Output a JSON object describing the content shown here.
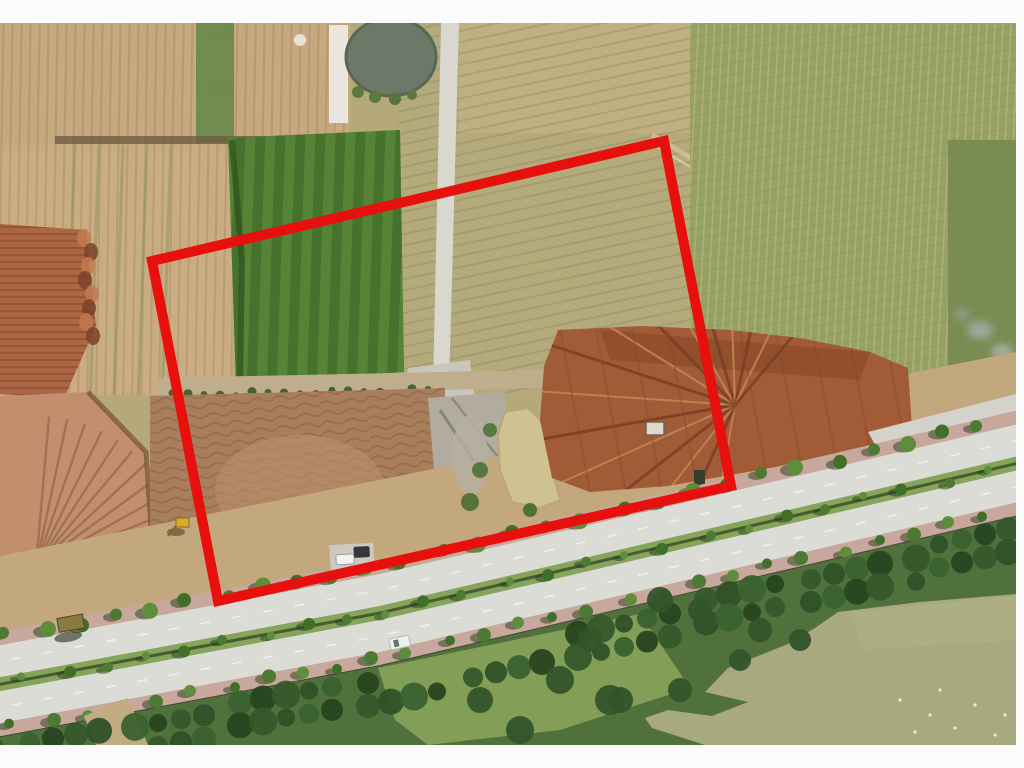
{
  "meta": {
    "type": "annotated-aerial-photograph",
    "alt": "Drone aerial view of cleared farmland and excavated earth parcels beside a tree-lined boulevard, with a red quadrilateral marking a land parcel boundary"
  },
  "frame": {
    "background": "#fbfbfb",
    "photo": {
      "x": 0,
      "y": 23,
      "width": 1016,
      "height": 722
    }
  },
  "annotation": {
    "name": "land-parcel-boundary",
    "color": "#e8100c",
    "stroke_width": 10,
    "points": "152,261 664,141 731,486 218,601"
  },
  "road": {
    "centerline": [
      [
        -20,
        692
      ],
      [
        380,
        617
      ],
      [
        1040,
        462
      ]
    ],
    "bands": [
      {
        "name": "sidewalk-north",
        "offset": -57,
        "width": 14,
        "color": "#c8a79c"
      },
      {
        "name": "carriageway-north",
        "offset": -43,
        "width": 32,
        "color": "#dbdcd5"
      },
      {
        "name": "median",
        "offset": -11,
        "width": 14,
        "color": "#86a45c"
      },
      {
        "name": "carriageway-south",
        "offset": 3,
        "width": 32,
        "color": "#dbdcd5"
      },
      {
        "name": "sidewalk-south",
        "offset": 35,
        "width": 13,
        "color": "#c8a79c"
      },
      {
        "name": "boundary-wall",
        "offset": 48,
        "width": 5,
        "color": "#41463a"
      }
    ],
    "lane_marks": {
      "color": "#f2f2ee",
      "offsets": [
        -27,
        19
      ],
      "dash": "10 22"
    },
    "median_line": {
      "color": "#3e5429",
      "offset": -4,
      "width": 3
    },
    "tree_rows": [
      {
        "offset": -51,
        "start": 8,
        "spacing": 36,
        "rmin": 6,
        "rmax": 8
      },
      {
        "offset": -4,
        "start": 26,
        "spacing": 40,
        "rmin": 4,
        "rmax": 6
      },
      {
        "offset": 41,
        "start": 14,
        "spacing": 36,
        "rmin": 5,
        "rmax": 7
      }
    ],
    "tree_colors": [
      "#4d7a33",
      "#5e8e3c",
      "#416f2a"
    ],
    "shadow_color": "#243d1c"
  },
  "palette": {
    "field_tan": "#c6a97e",
    "field_khaki": "#b4ab7c",
    "field_green": "#95a263",
    "crop_green": "#4f7c34",
    "earth_orange": "#a15c37",
    "earth_terrace": "#ac6644",
    "earth_fan": "#c18f6e",
    "dirt_brown": "#a87e5c",
    "pond_dark": "#6d7968",
    "pond_muddy": "#cfc291",
    "pond_olive": "#a8a97f",
    "road_concrete": "#dbdcd5",
    "sidewalk_pink": "#c8a79c",
    "median_green": "#86a45c",
    "vegetation_dark": "#385c2c",
    "white_margin": "#fbfbfb"
  }
}
